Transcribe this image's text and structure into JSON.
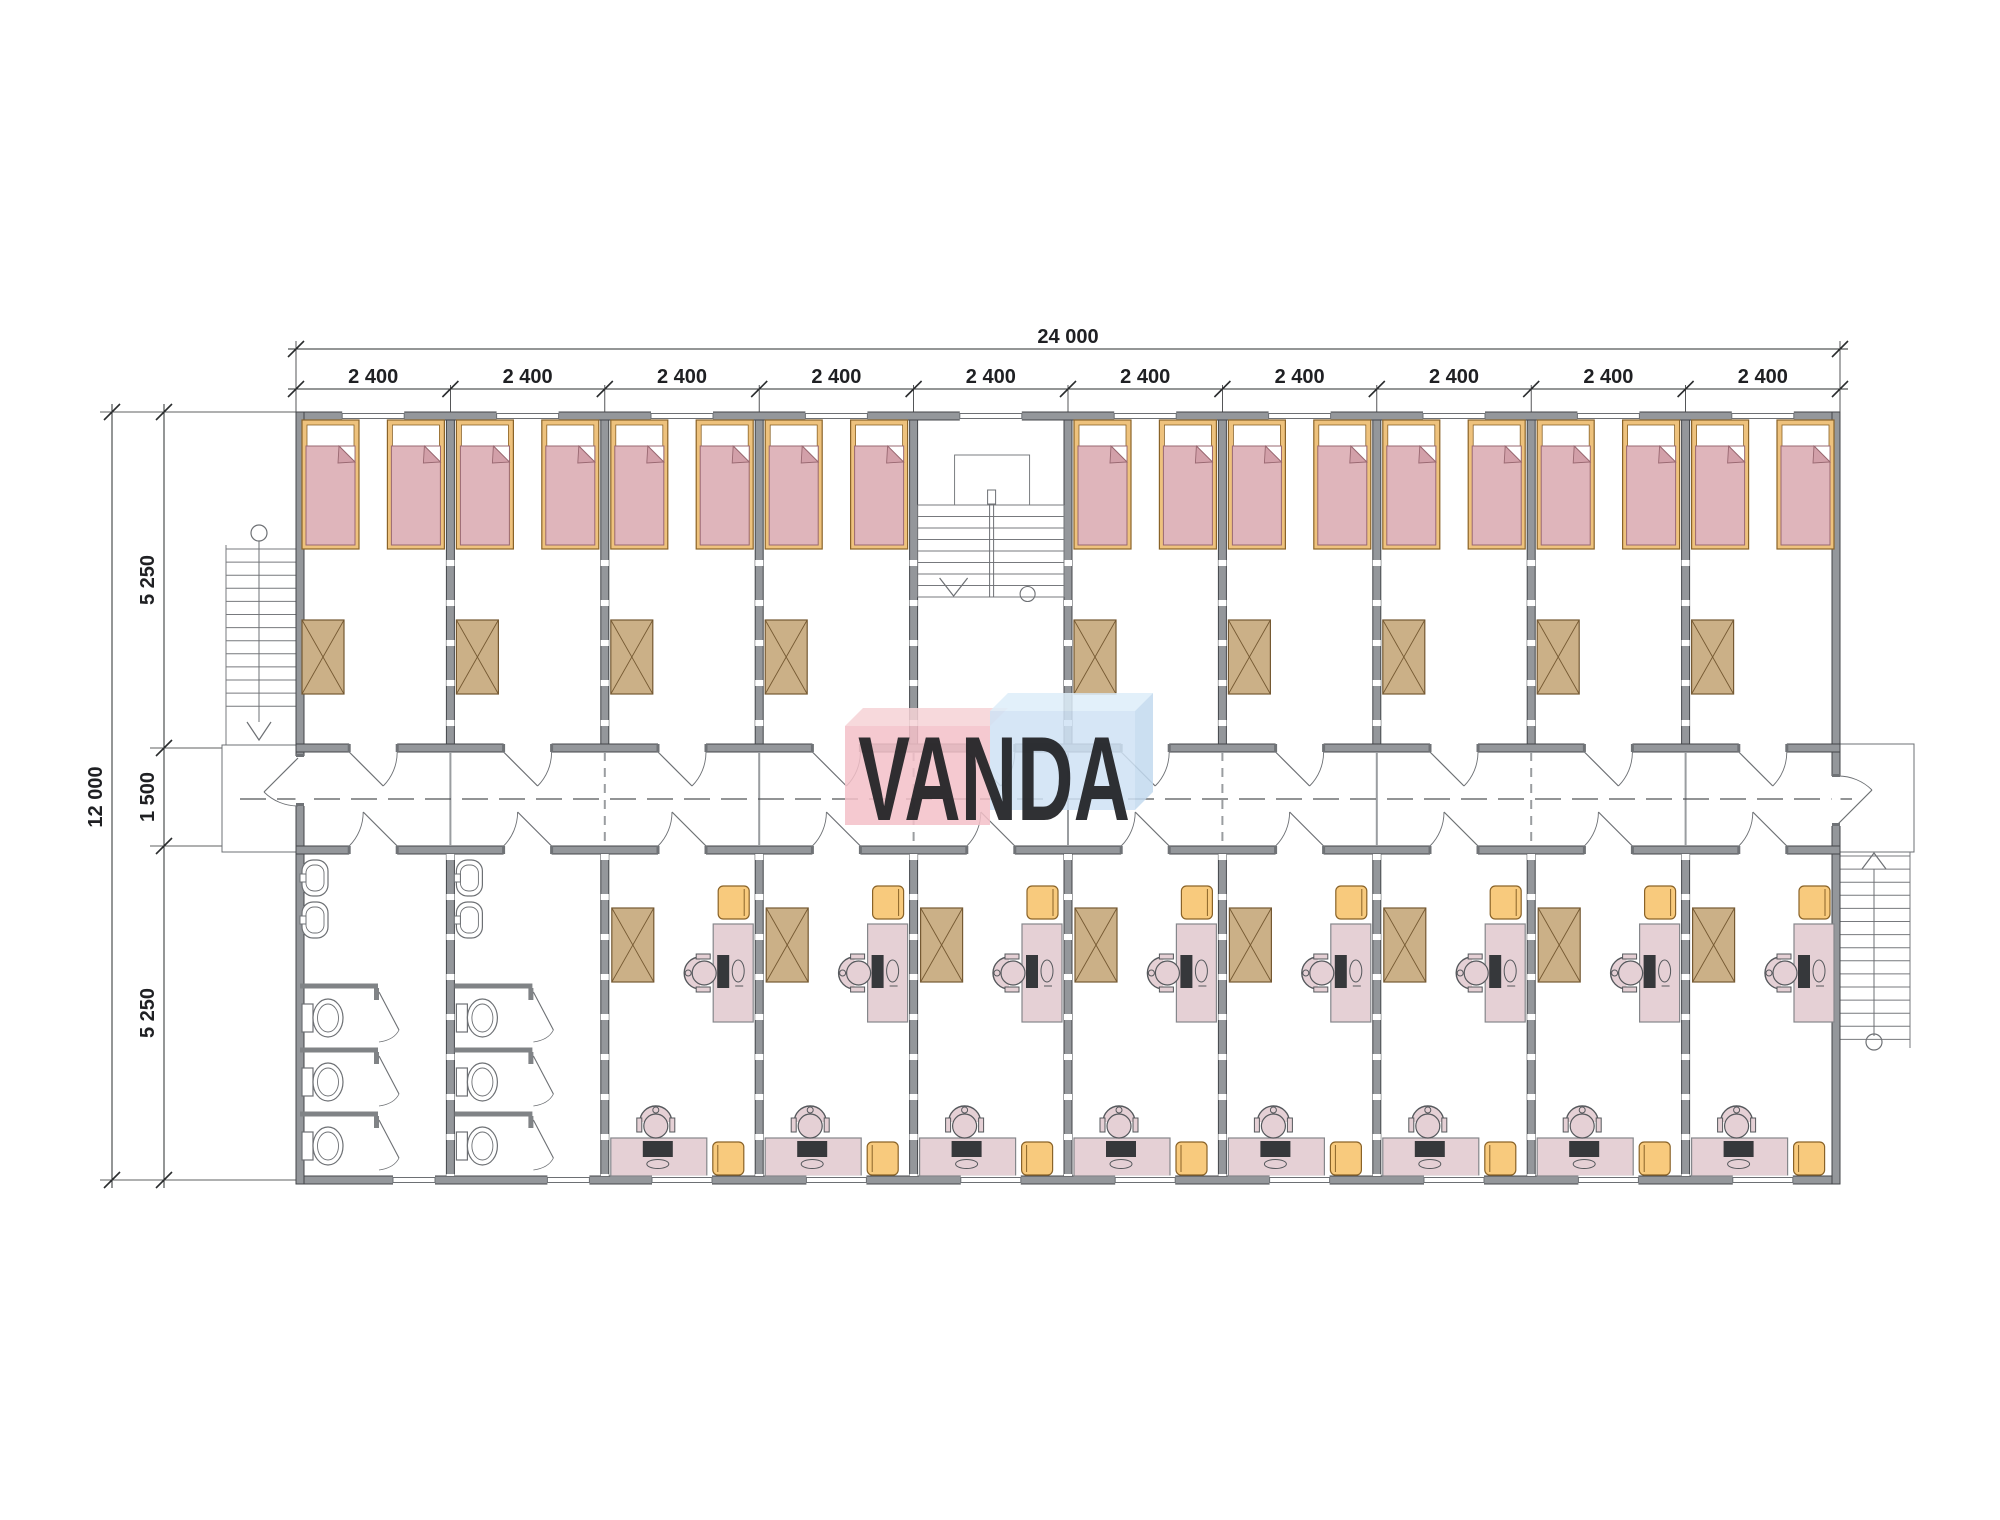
{
  "logo": {
    "text": "VANDA",
    "pink_front": "#f3c0c8",
    "pink_top": "#f6d2d6",
    "blue_front": "#cfe2f4",
    "blue_top": "#ddedf9",
    "blue_side": "#c2d9ee",
    "text_color": "#ffffff"
  },
  "dimensions": {
    "total_width": "24 000",
    "module_widths": [
      "2 400",
      "2 400",
      "2 400",
      "2 400",
      "2 400",
      "2 400",
      "2 400",
      "2 400",
      "2 400",
      "2 400"
    ],
    "total_height": "12 000",
    "height_segments": [
      "5 250",
      "1 500",
      "5 250"
    ]
  },
  "plan": {
    "modules": 10,
    "stair_module_index": 4,
    "bathroom_module_indexes": [
      0,
      1
    ],
    "office_module_indexes": [
      2,
      3,
      4,
      5,
      6,
      7,
      8,
      9
    ],
    "beds_per_bedroom": 2,
    "wardrobes_per_bedroom": 1,
    "sinks_per_bathroom": 2,
    "toilets_per_bathroom": 3,
    "desks_per_office": 2,
    "colors": {
      "wall": "#94979b",
      "wall_stroke": "#43464a",
      "wall_dark_post": "#6f7276",
      "fixture": "#6d7074",
      "stair_line": "#77797d",
      "bed_frame": "#eec27d",
      "bed_frame_stroke": "#8a6328",
      "mattress": "#dfb5bb",
      "mattress_stroke": "#996871",
      "mattress_flap": "#d2a0a9",
      "pillow": "#ffffff",
      "wardrobe": "#cbb087",
      "wardrobe_stroke": "#755932",
      "stool": "#f8ca7d",
      "stool_stroke": "#8a6328",
      "desk": "#e5d0d5",
      "desk_stroke": "#85878b",
      "chair": "#e5d0d5",
      "chair_stroke": "#55585c",
      "monitor": "#36383b",
      "dim_line": "#2a2c2e",
      "corridor_dash": "#505356"
    }
  }
}
